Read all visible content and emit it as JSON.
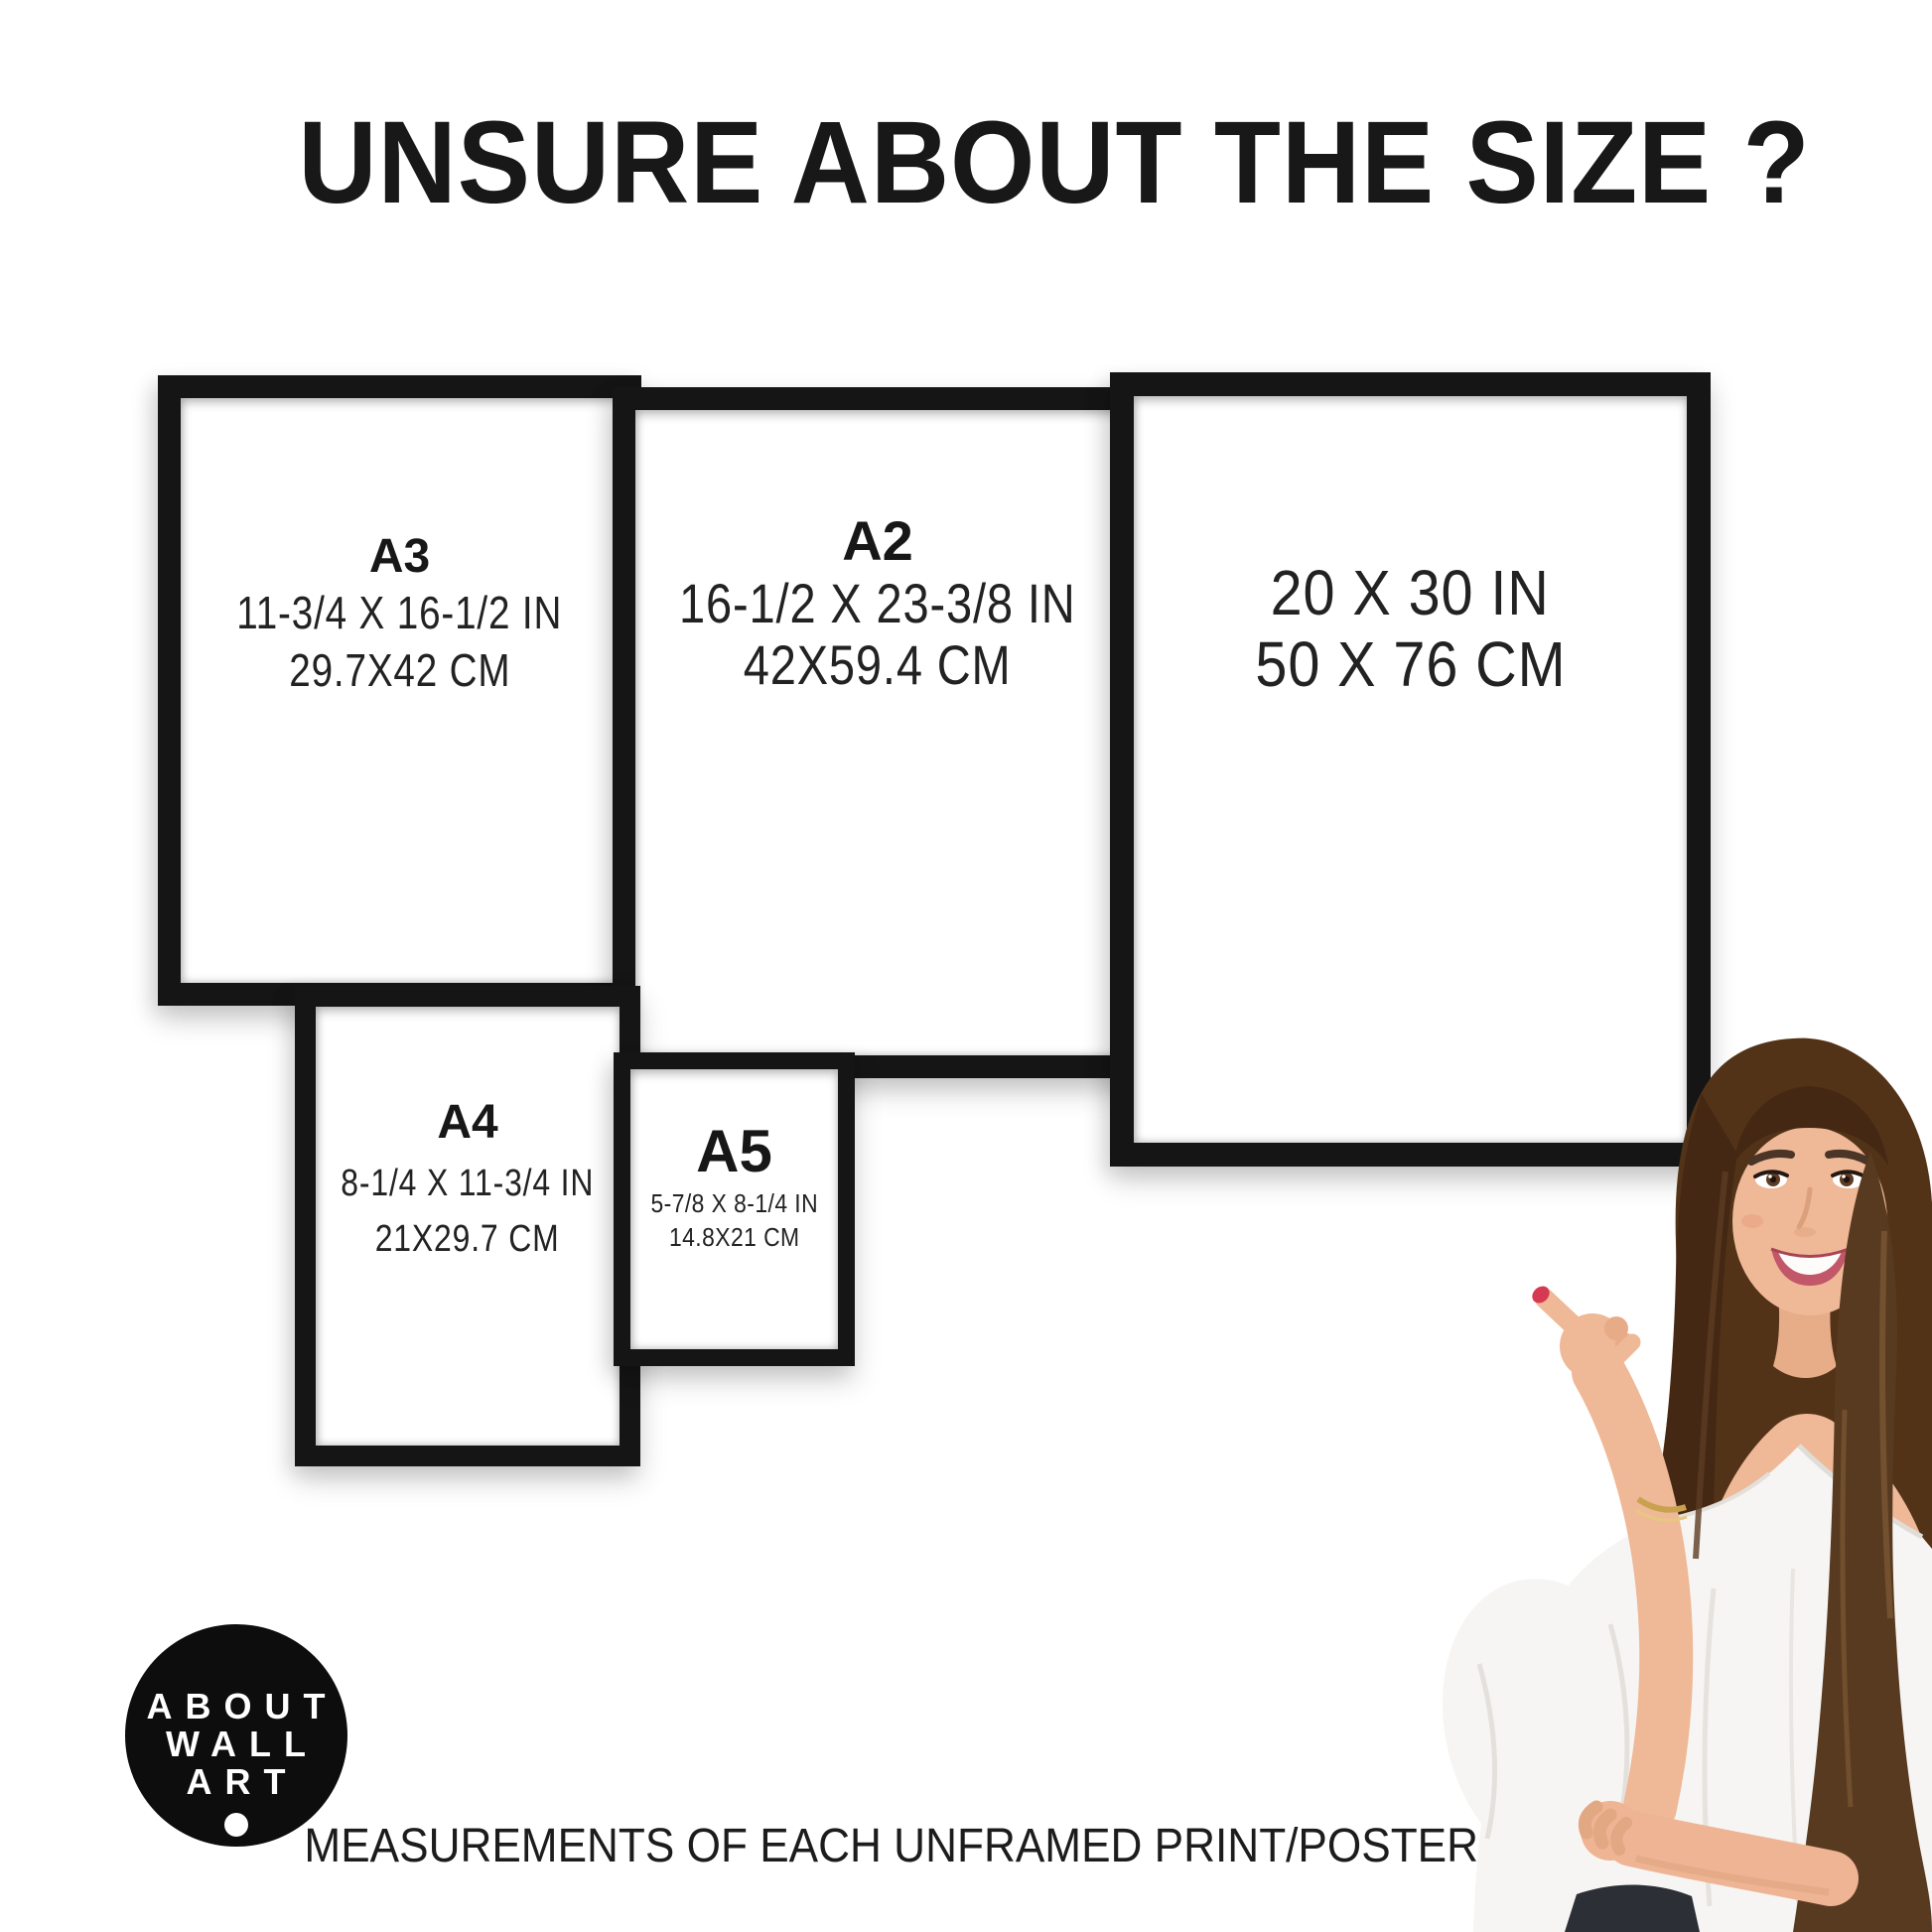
{
  "title": "UNSURE ABOUT THE SIZE ?",
  "frames": {
    "a3": {
      "label": "A3",
      "inches": "11-3/4 X 16-1/2 IN",
      "cm": "29.7X42 CM"
    },
    "a2": {
      "label": "A2",
      "inches": "16-1/2 X 23-3/8 IN",
      "cm": "42X59.4 CM"
    },
    "p2030": {
      "inches": "20 X 30 IN",
      "cm": "50 X 76 CM"
    },
    "a4": {
      "label": "A4",
      "inches": "8-1/4 X 11-3/4 IN",
      "cm": "21X29.7 CM"
    },
    "a5": {
      "label": "A5",
      "inches": "5-7/8 X 8-1/4 IN",
      "cm": "14.8X21 CM"
    }
  },
  "logo": {
    "line1": "ABOUT",
    "line2": "WALL",
    "line3": "ART"
  },
  "caption": "MEASUREMENTS OF EACH UNFRAMED PRINT/POSTER",
  "colors": {
    "background": "#ffffff",
    "frame_border": "#151515",
    "text": "#1d1d1d",
    "logo_bg": "#0d0d0d",
    "logo_text": "#ffffff",
    "nail_polish": "#d63a52",
    "hair": "#523318",
    "skin": "#efb897",
    "blouse": "#f6f5f3"
  }
}
